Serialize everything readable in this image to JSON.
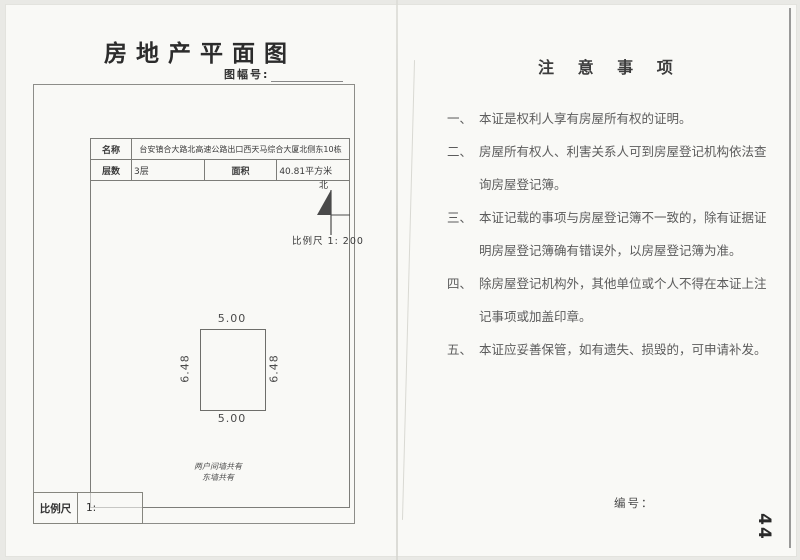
{
  "left_page": {
    "title": "房地产平面图",
    "sheet_no_label": "图幅号:",
    "info_table": {
      "name_label": "名称",
      "name_value": "台安镇合大路北高速公路出口西天马综合大厦北侧东10栋",
      "floors_label": "层数",
      "floors_value": "3层",
      "area_label": "面积",
      "area_value": "40.81平方米"
    },
    "north_label": "北",
    "scale_note": "比例尺 1: 200",
    "plan": {
      "dim_top": "5.00",
      "dim_bottom": "5.00",
      "dim_left": "6.48",
      "dim_right": "6.48",
      "wall_note_line1": "两户间墙共有",
      "wall_note_line2": "东墙共有"
    },
    "scale_box": {
      "label": "比例尺",
      "value": "1:"
    }
  },
  "right_page": {
    "title": "注 意 事 项",
    "items": [
      {
        "no": "一、",
        "text": "本证是权利人享有房屋所有权的证明。"
      },
      {
        "no": "二、",
        "text": "房屋所有权人、利害关系人可到房屋登记机构依法查询房屋登记簿。"
      },
      {
        "no": "三、",
        "text": "本证记载的事项与房屋登记簿不一致的，除有证据证明房屋登记簿确有错误外，以房屋登记簿为准。"
      },
      {
        "no": "四、",
        "text": "除房屋登记机构外，其他单位或个人不得在本证上注记事项或加盖印章。"
      },
      {
        "no": "五、",
        "text": "本证应妥善保管，如有遗失、损毁的，可申请补发。"
      }
    ],
    "serial_label": "编号：",
    "page_number": "44"
  },
  "colors": {
    "paper": "#f9f9f6",
    "ink": "#2c2c2c",
    "frame_line": "#8d8d89",
    "faded_text": "#5c5c5c"
  }
}
